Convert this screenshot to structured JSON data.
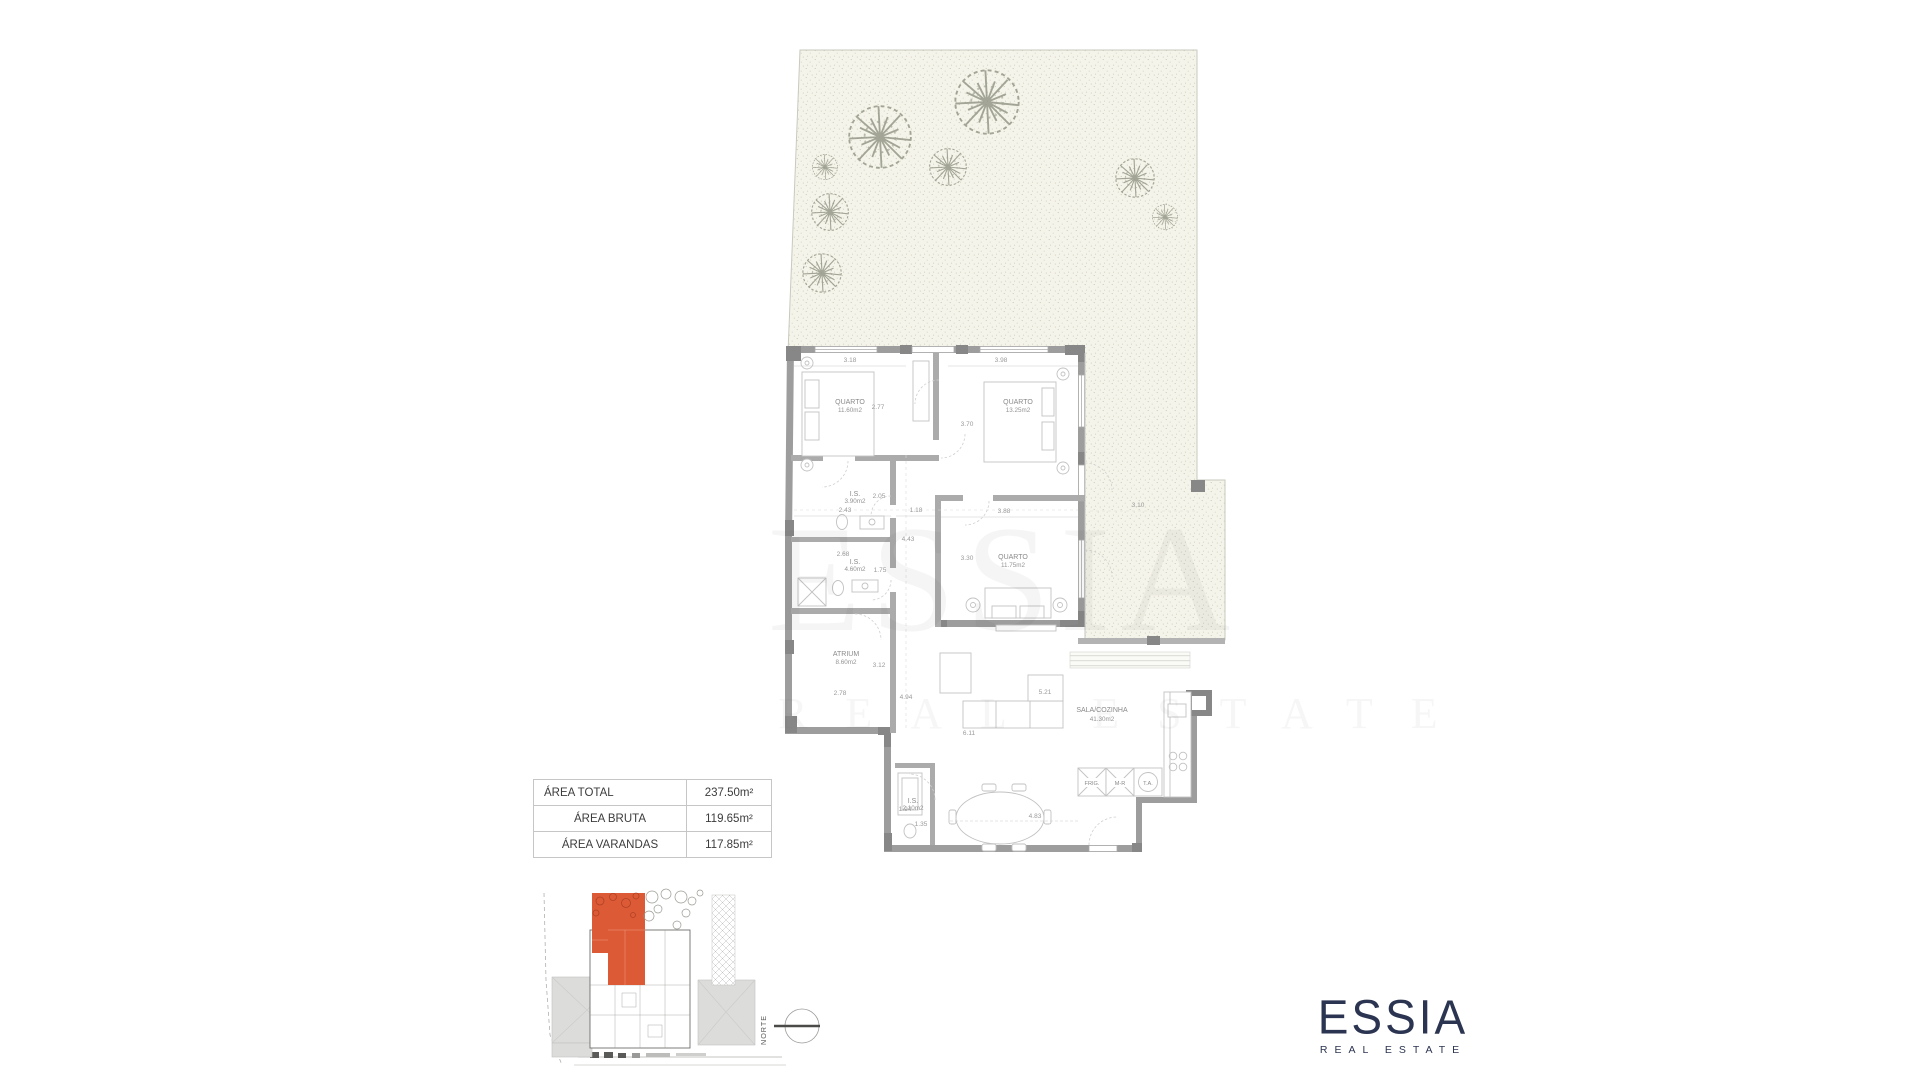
{
  "area_table": {
    "rows": [
      {
        "label": "ÁREA TOTAL",
        "value": "237.50m²"
      },
      {
        "label": "ÁREA BRUTA",
        "value": "119.65m²"
      },
      {
        "label": "ÁREA VARANDAS",
        "value": "117.85m²"
      }
    ]
  },
  "floorplan": {
    "rooms": {
      "quarto1": {
        "name": "QUARTO",
        "area": "11.60m2"
      },
      "quarto2": {
        "name": "QUARTO",
        "area": "13.25m2"
      },
      "is1": {
        "name": "I.S.",
        "area": "3.90m2"
      },
      "is2": {
        "name": "I.S.",
        "area": "4.60m2"
      },
      "quarto3": {
        "name": "QUARTO",
        "area": "11.75m2"
      },
      "atrium": {
        "name": "ATRIUM",
        "area": "8.60m2"
      },
      "sala": {
        "name": "SALA/COZINHA",
        "area": "41.30m2"
      },
      "is3": {
        "name": "I.S.",
        "area": "2.10m2"
      }
    },
    "dims": {
      "d1": "3.18",
      "d2": "2.77",
      "d3": "3.98",
      "d4": "3.70",
      "d5": "2.43",
      "d6": "2.05",
      "d7": "1.18",
      "d8": "3.88",
      "d9": "3.10",
      "d10": "4.43",
      "d11": "2.68",
      "d12": "1.75",
      "d13": "3.30",
      "d14": "3.12",
      "d15": "2.78",
      "d16": "4.94",
      "d17": "5.21",
      "d18": "6.11",
      "d19": "1.94",
      "d20": "1.35",
      "d21": "4.83"
    },
    "kitchen": [
      "FRIG.",
      "M-R",
      "T.A."
    ]
  },
  "site_plan": {
    "north_label": "NORTE",
    "highlight_color": "#dc5a36"
  },
  "watermark": {
    "line1": "ESSIA",
    "line2": "REAL ESTATE"
  },
  "logo": {
    "name": "ESSIA",
    "tagline": "REAL ESTATE",
    "color": "#2b3450"
  }
}
